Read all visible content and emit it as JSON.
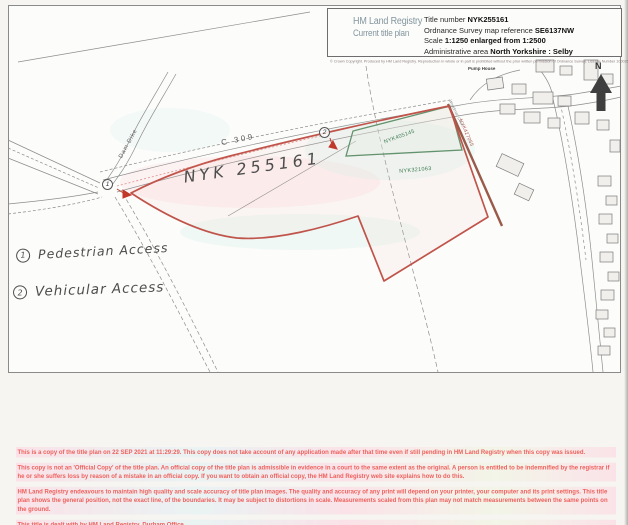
{
  "header": {
    "brand_line1": "HM Land Registry",
    "brand_line2": "Current title plan",
    "fields": [
      {
        "label": "Title number ",
        "value": "NYK255161"
      },
      {
        "label": "Ordnance Survey map reference ",
        "value": "SE6137NW"
      },
      {
        "label": "Scale ",
        "value": "1:1250 enlarged from 1:2500"
      },
      {
        "label": "Administrative area ",
        "value": "North Yorkshire : Selby"
      }
    ],
    "copyright": "© Crown Copyright. Produced by HM Land Registry. Reproduction in whole or in part is prohibited without the prior written permission of Ordnance Survey. Licence Number 100026316."
  },
  "map": {
    "north_label": "N",
    "labels": {
      "pump_house": "Pump House",
      "stream": "Dam Dike",
      "road": "C 309",
      "handwritten_title": "NYK 255161",
      "green_parcel_1": "NYK405145",
      "green_parcel_2": "NYK321063",
      "red_parcel_edge": "NYK427065",
      "street": "Woodman Court"
    },
    "markers": {
      "m1": "1",
      "m2": "2"
    }
  },
  "legend": {
    "items": [
      {
        "num": "1",
        "label": "Pedestrian Access"
      },
      {
        "num": "2",
        "label": "Vehicular Access"
      }
    ]
  },
  "footer": {
    "paragraphs": [
      "This is a copy of the title plan on 22 SEP 2021 at 11:29:29. This copy does not take account of any application made after that time even if still pending in HM Land Registry when this copy was issued.",
      "This copy is not an 'Official Copy' of the title plan. An official copy of the title plan is admissible in evidence in a court to the same extent as the original. A person is entitled to be indemnified by the registrar if he or she suffers loss by reason of a mistake in an official copy. If you want to obtain an official copy, the HM Land Registry web site explains how to do this.",
      "HM Land Registry endeavours to maintain high quality and scale accuracy of title plan images. The quality and accuracy of any print will depend on your printer, your computer and its print settings. This title plan shows the general position, not the exact line, of the boundaries. It may be subject to distortions in scale. Measurements scaled from this plan may not match measurements between the same points on the ground.",
      "This title is dealt with by HM Land Registry, Durham Office."
    ]
  },
  "colors": {
    "boundary_red": "#c0544b",
    "boundary_green": "#4c8a60",
    "boundary_brown": "#9a5a49",
    "brand_teal": "#83969f",
    "warning_red": "#ee615d",
    "logo_green": "#93b04c",
    "logo_yellow": "#e0e25a"
  }
}
